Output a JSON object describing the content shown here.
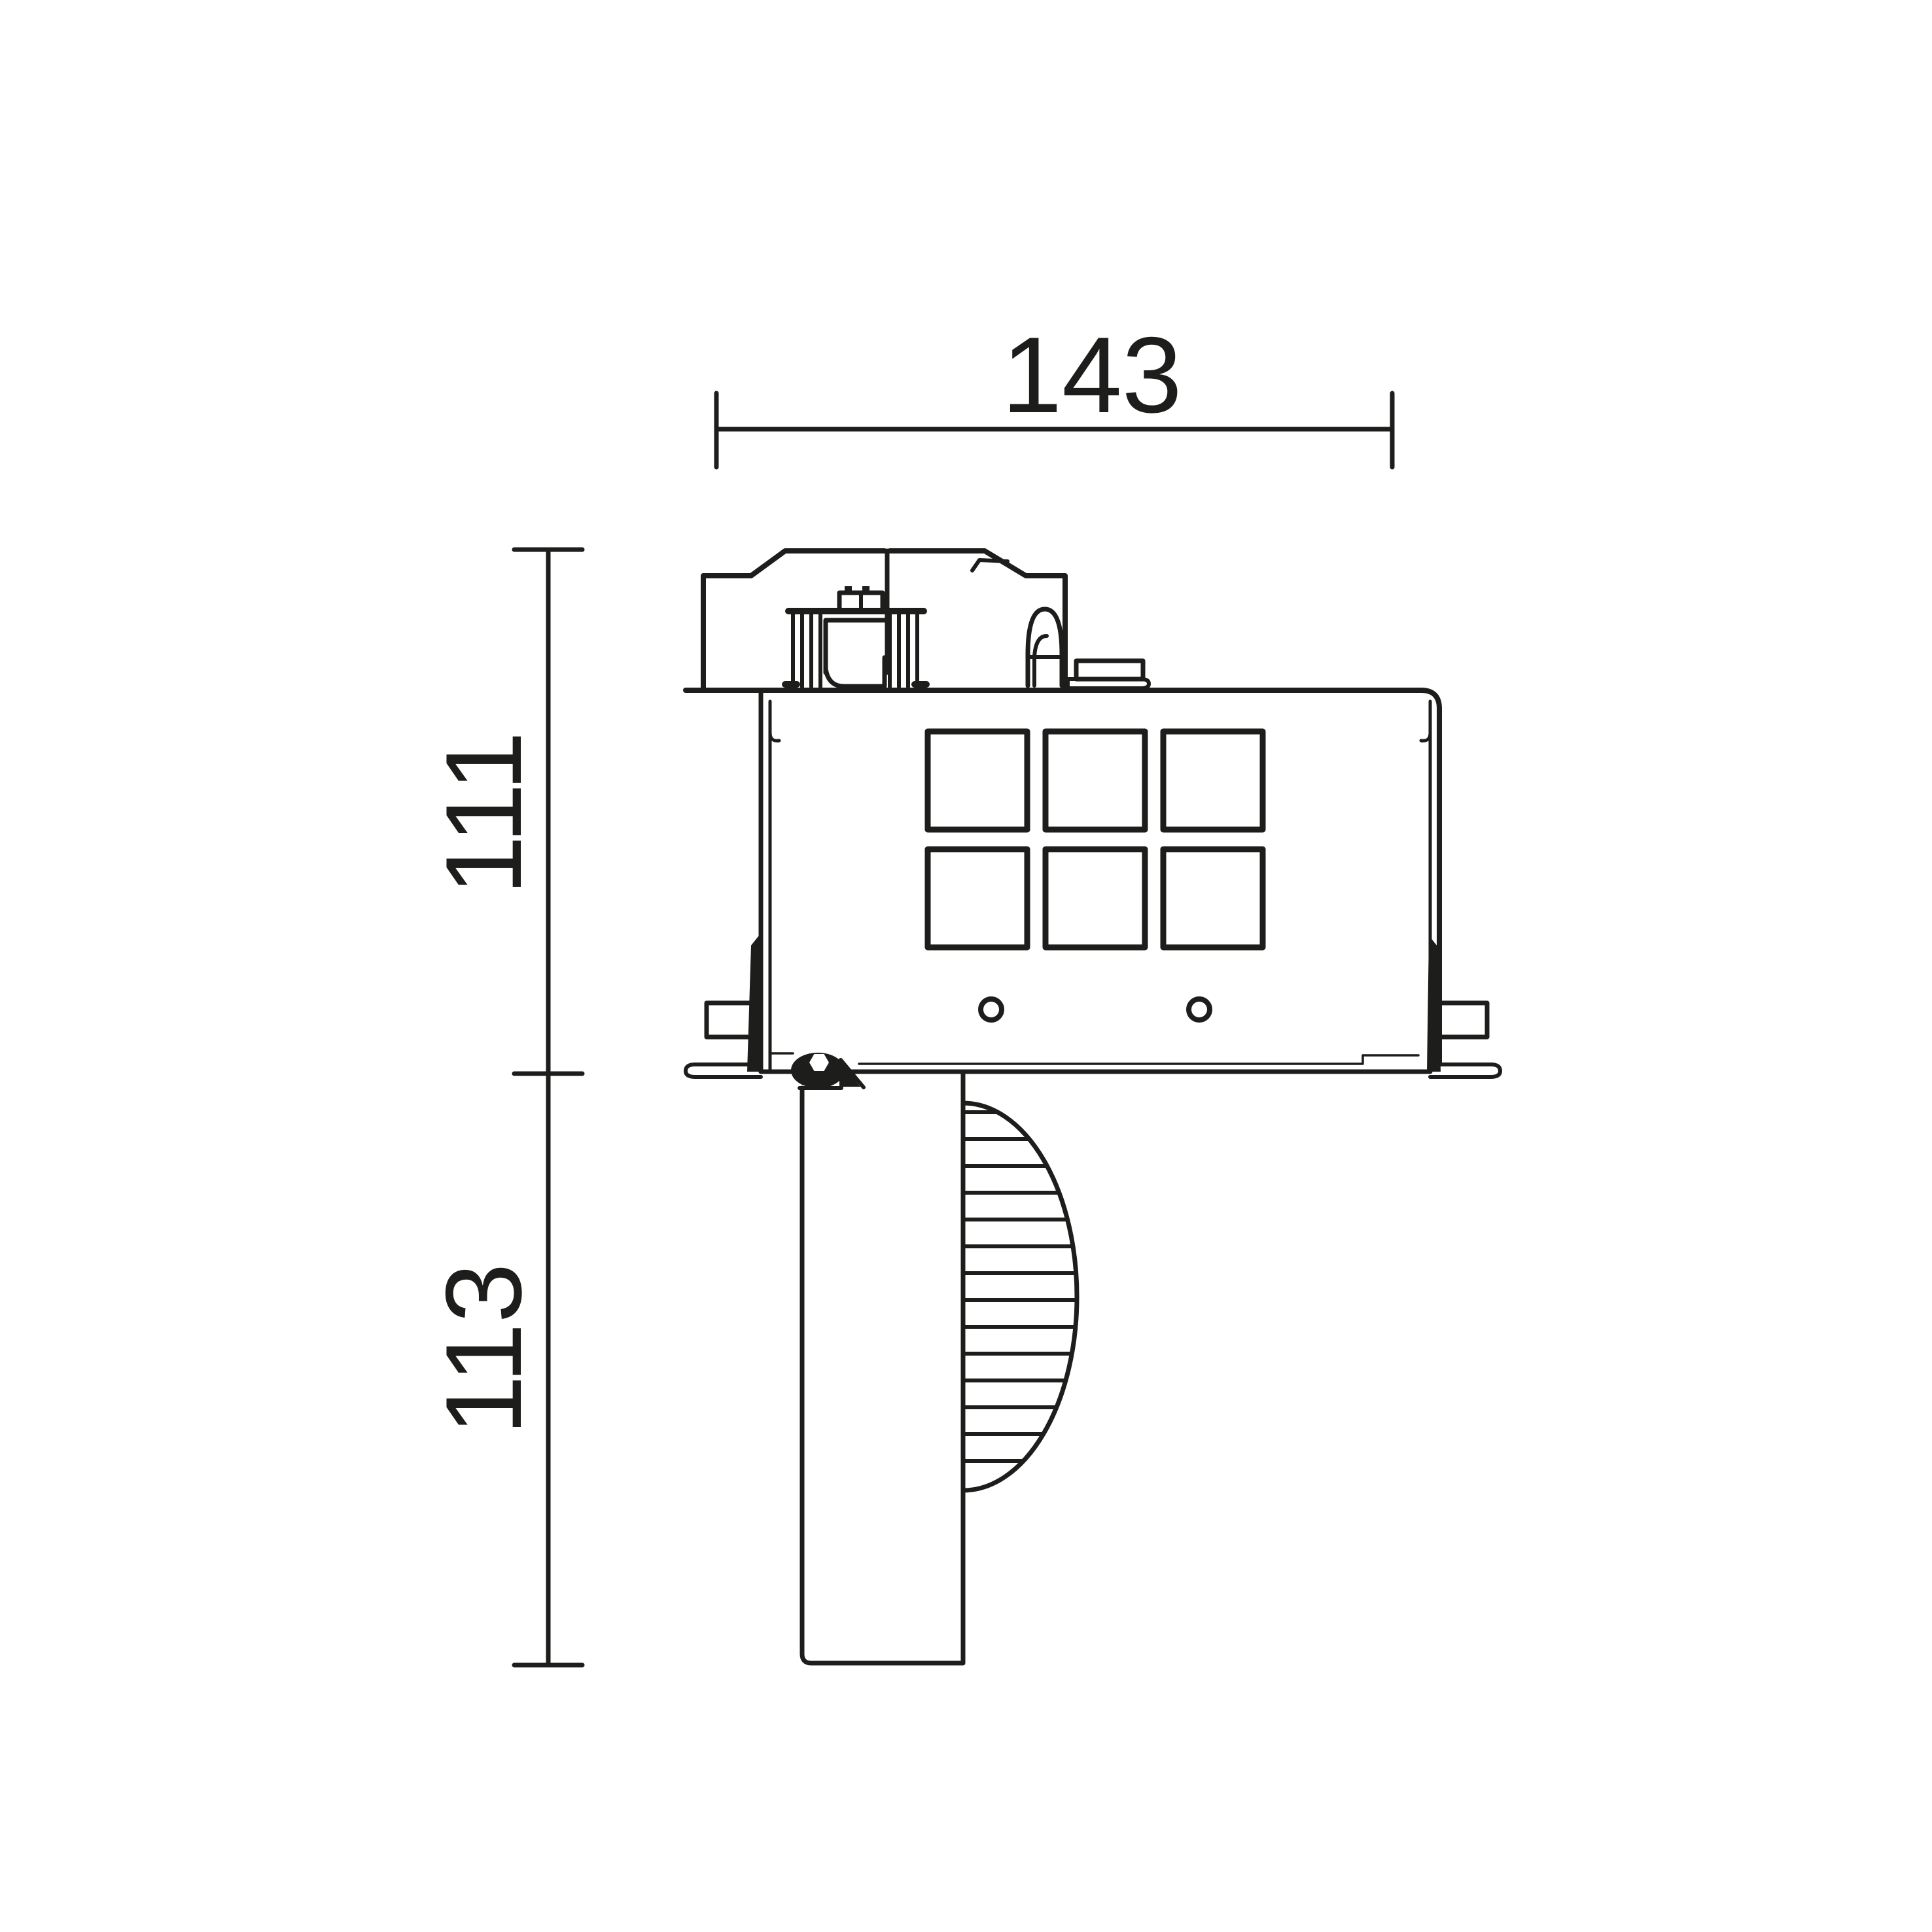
{
  "page": {
    "background": "#ffffff",
    "ink_color": "#1d1d1b"
  },
  "dimensions": {
    "width": {
      "label": "143"
    },
    "upper_height": {
      "label": "111"
    },
    "lower_height": {
      "label": "113"
    }
  }
}
